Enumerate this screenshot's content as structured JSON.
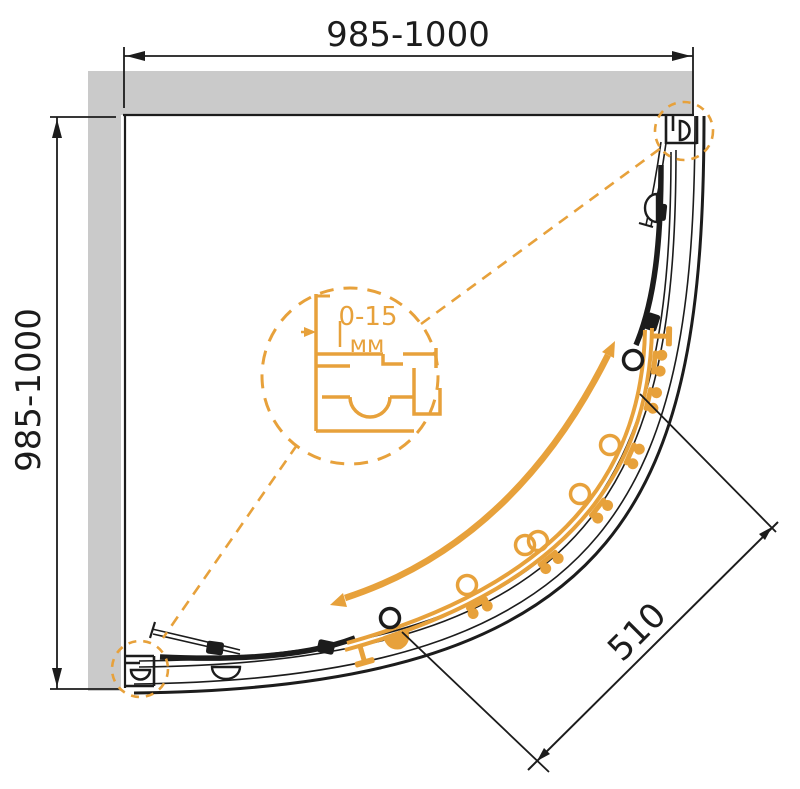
{
  "drawing": {
    "title": "quadrant-shower-enclosure-plan",
    "width_dim": "985-1000",
    "height_dim": "985-1000",
    "opening_dim": "510",
    "detail_range": "0-15",
    "detail_unit": "мм"
  },
  "colors": {
    "accent_orange": "#E7A13B",
    "wall_gray": "#CACACA",
    "line_black": "#1C1C1C",
    "background": "#FFFFFF"
  }
}
